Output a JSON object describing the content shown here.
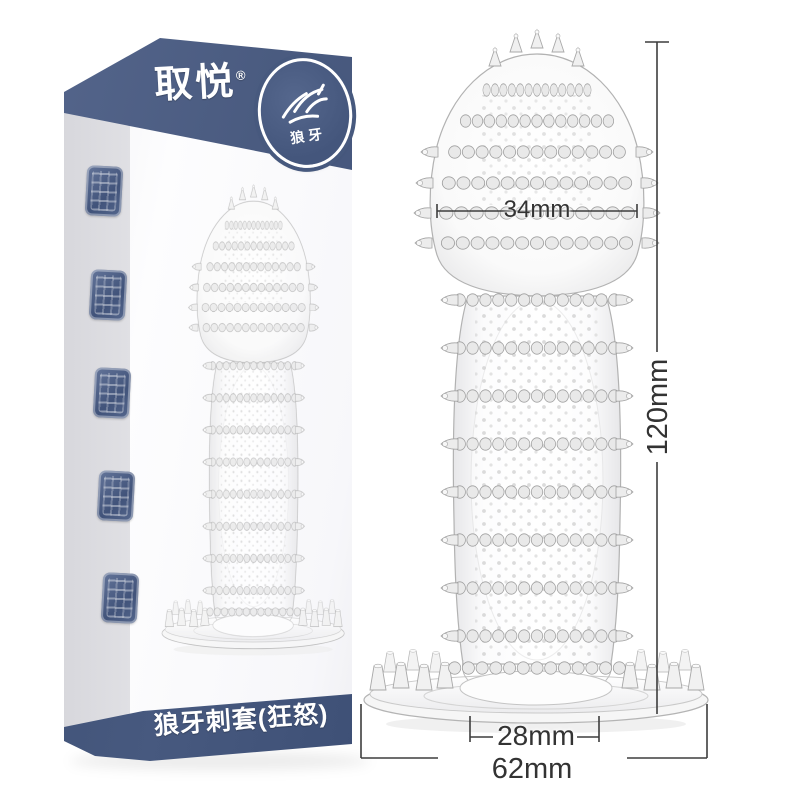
{
  "colors": {
    "accent_navy": "#4a5b80",
    "accent_navy_dark": "#44567c",
    "dimension_line": "#3d3d3d",
    "product_outline": "#b2b2b2"
  },
  "box": {
    "brand": "取悦",
    "registered_mark": "®",
    "badge": {
      "label": "狼牙"
    },
    "bottom_title": "狼牙刺套(狂怒)"
  },
  "dimensions": {
    "head_width": "34mm",
    "total_length": "120mm",
    "opening_width": "28mm",
    "base_width": "62mm"
  }
}
